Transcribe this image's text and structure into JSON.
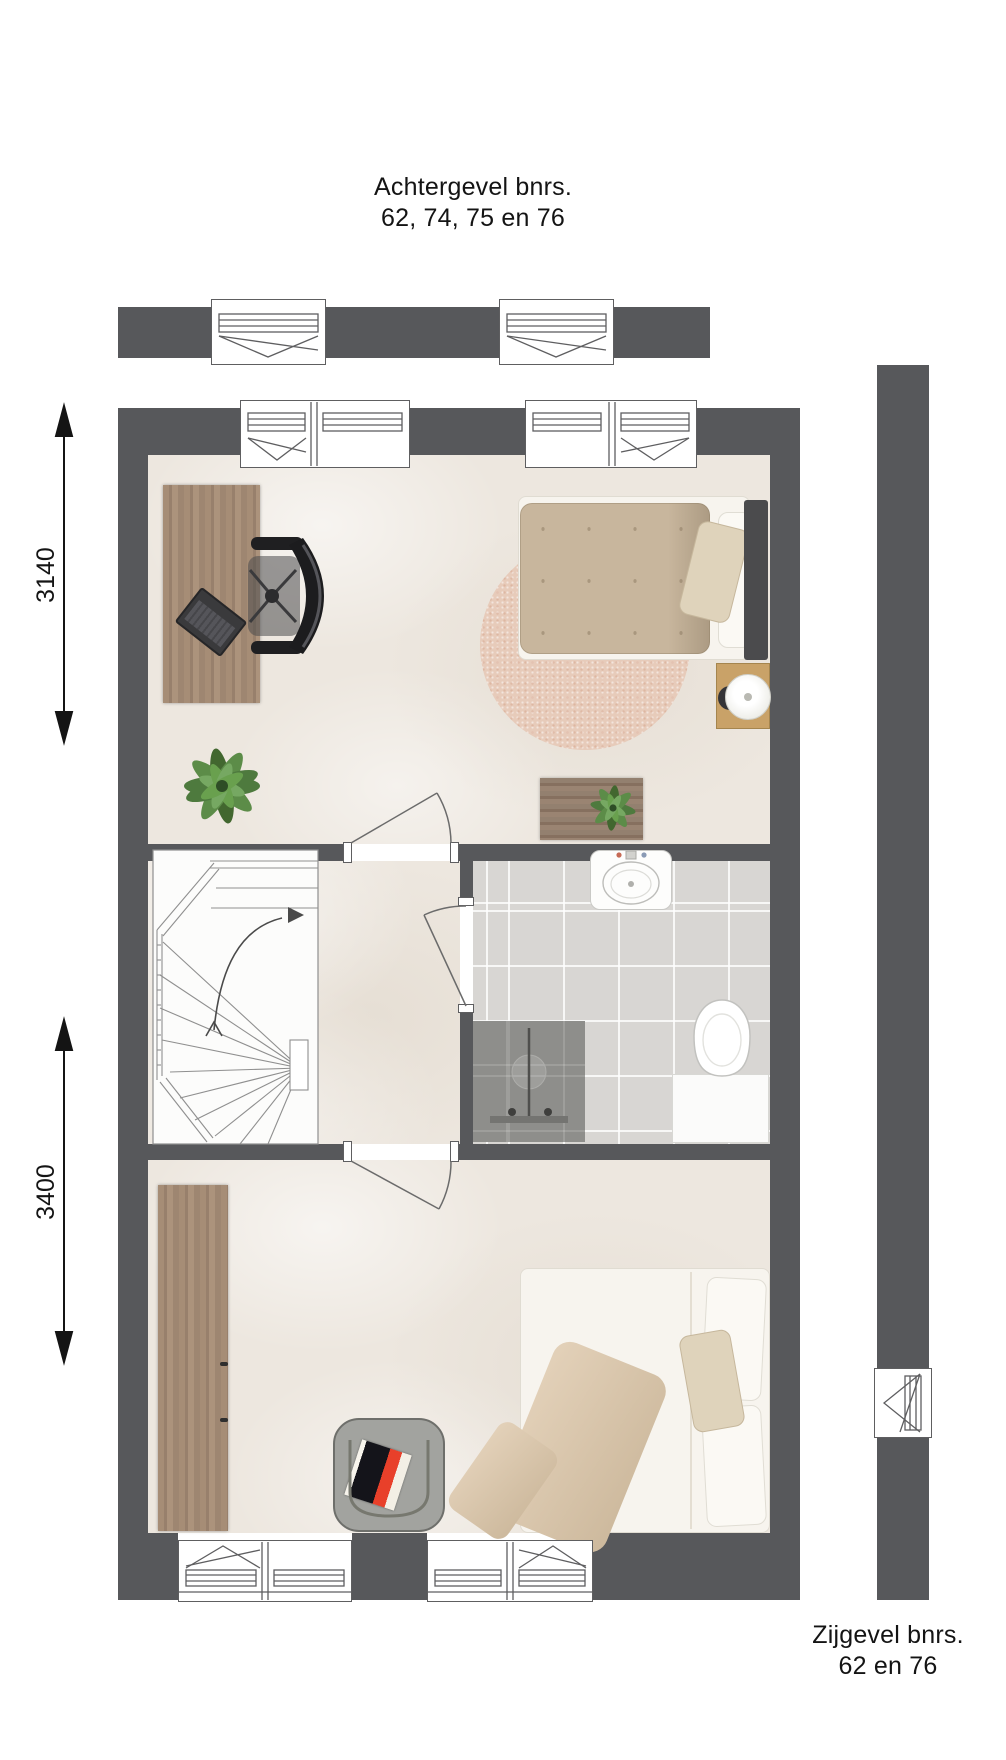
{
  "back_facade_label": {
    "line1": "Achtergevel bnrs.",
    "line2": "62, 74, 75 en 76"
  },
  "side_facade_label": {
    "line1": "Zijgevel bnrs.",
    "line2": "62 en 76"
  },
  "dimensions": [
    {
      "name": "upper-room-depth",
      "value": "3140"
    },
    {
      "name": "lower-room-depth",
      "value": "3400"
    }
  ],
  "colors": {
    "wall": "#57585B",
    "floor": "#EDE7DF",
    "bathroom_tile": "#D8D6D3",
    "shower_tile": "#8E8E8B",
    "wood": "#A18A74",
    "oak_nightstand": "#C9A268",
    "rug": "#E7CBBA",
    "duvet_taupe": "#C8B69D",
    "accent_red": "#E8402A",
    "plant_green": "#5C8C48",
    "text": "#141414"
  }
}
